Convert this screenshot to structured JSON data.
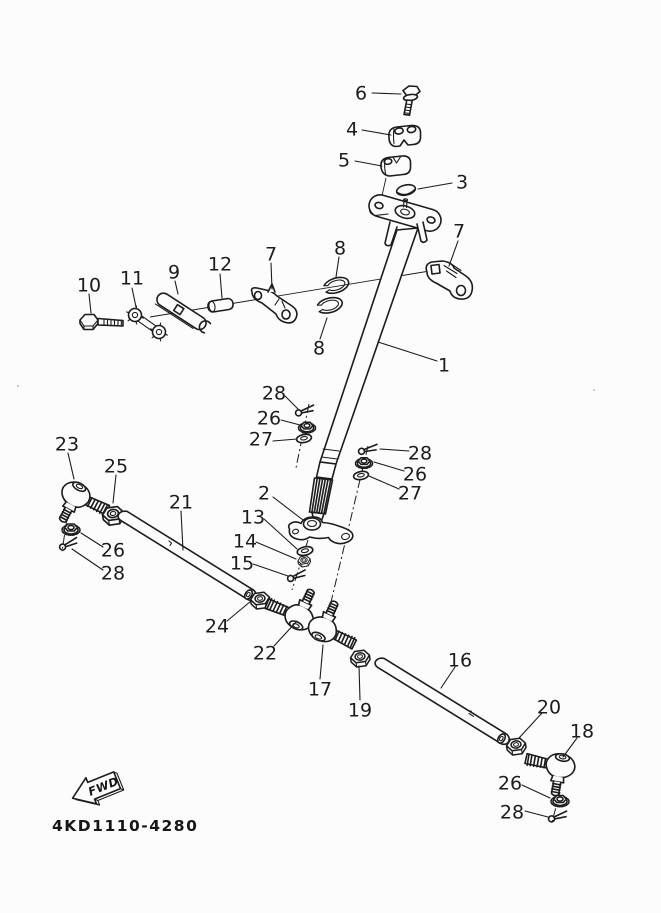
{
  "meta": {
    "background": "#fcfcfc",
    "ink_color": "#1c1c1c",
    "diagram_type": "exploded-parts-diagram",
    "subject": "steering assembly"
  },
  "footer": {
    "diagram_code": "4KD1110-4280",
    "fwd_label": "FWD"
  },
  "callouts": [
    {
      "num": "6",
      "part": "handlebar-clamp-bolt"
    },
    {
      "num": "4",
      "part": "handlebar-upper-holder"
    },
    {
      "num": "5",
      "part": "handlebar-lower-holder"
    },
    {
      "num": "3",
      "part": "steering-stem-cap"
    },
    {
      "num": "7",
      "part": "steering-shaft-bracket-right"
    },
    {
      "num": "7",
      "part": "steering-shaft-bracket-left"
    },
    {
      "num": "8",
      "part": "seal-ring-upper"
    },
    {
      "num": "8",
      "part": "seal-ring-lower"
    },
    {
      "num": "12",
      "part": "collar"
    },
    {
      "num": "9",
      "part": "plate-lever"
    },
    {
      "num": "11",
      "part": "connecting-link"
    },
    {
      "num": "10",
      "part": "bolt"
    },
    {
      "num": "1",
      "part": "steering-shaft"
    },
    {
      "num": "28",
      "part": "cotter-pin-mid-left"
    },
    {
      "num": "26",
      "part": "nut-mid-left"
    },
    {
      "num": "27",
      "part": "washer-mid-left"
    },
    {
      "num": "28",
      "part": "cotter-pin-mid-right"
    },
    {
      "num": "26",
      "part": "nut-mid-right"
    },
    {
      "num": "27",
      "part": "washer-mid-right"
    },
    {
      "num": "23",
      "part": "tie-rod-end-left"
    },
    {
      "num": "25",
      "part": "nut-left"
    },
    {
      "num": "21",
      "part": "tie-rod-left"
    },
    {
      "num": "2",
      "part": "steering-arm"
    },
    {
      "num": "13",
      "part": "washer"
    },
    {
      "num": "14",
      "part": "nut"
    },
    {
      "num": "15",
      "part": "cotter-pin"
    },
    {
      "num": "26",
      "part": "nut-lower-left"
    },
    {
      "num": "28",
      "part": "cotter-pin-lower-left"
    },
    {
      "num": "24",
      "part": "nut-center"
    },
    {
      "num": "22",
      "part": "tie-rod-end-center-left"
    },
    {
      "num": "17",
      "part": "tie-rod-end-center-right"
    },
    {
      "num": "19",
      "part": "nut-center-right"
    },
    {
      "num": "16",
      "part": "tie-rod-right"
    },
    {
      "num": "20",
      "part": "nut-right"
    },
    {
      "num": "18",
      "part": "tie-rod-end-right"
    },
    {
      "num": "26",
      "part": "nut-bottom-right"
    },
    {
      "num": "28",
      "part": "cotter-pin-bottom-right"
    }
  ]
}
